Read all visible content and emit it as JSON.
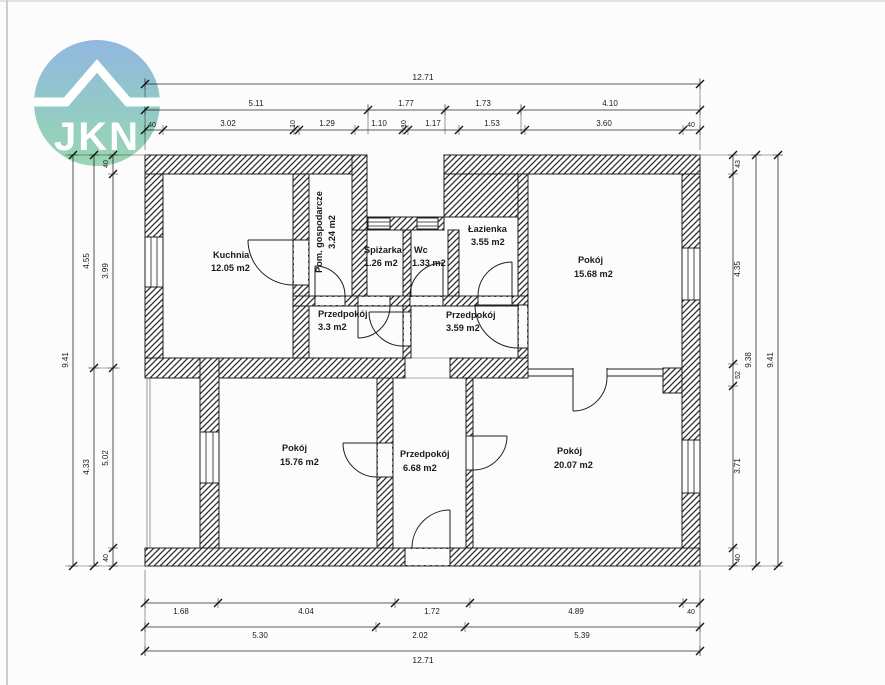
{
  "logo": {
    "text": "JKN"
  },
  "colors": {
    "logo_top": "#8bb3e2",
    "logo_bottom": "#93d6ac",
    "line": "#1f1f1f",
    "background": "#fcfcfc"
  },
  "rooms": {
    "kuchnia": {
      "name": "Kuchnia",
      "area": "12.05 m2"
    },
    "pom_gosp": {
      "name": "Pom. gospodarcze",
      "area": "3.24 m2"
    },
    "spizarka": {
      "name": "Spiżarka",
      "area": "1.26 m2"
    },
    "wc": {
      "name": "Wc",
      "area": "1.33 m2"
    },
    "lazienka": {
      "name": "Łazienka",
      "area": "3.55 m2"
    },
    "pokoj_gorny": {
      "name": "Pokój",
      "area": "15.68 m2"
    },
    "przedpokoj_1": {
      "name": "Przedpokój",
      "area": "3.3 m2"
    },
    "przedpokoj_2": {
      "name": "Przedpokój",
      "area": "3.59 m2"
    },
    "pokoj_dolny_lewy": {
      "name": "Pokój",
      "area": "15.76 m2"
    },
    "przedpokoj_3": {
      "name": "Przedpokój",
      "area": "6.68 m2"
    },
    "pokoj_dolny_prawy": {
      "name": "Pokój",
      "area": "20.07 m2"
    }
  },
  "dims": {
    "top_total": "12.71",
    "top_row2": [
      "5.11",
      "1.77",
      "1.73",
      "4.10"
    ],
    "top_row3": [
      "40",
      "3.02",
      "10",
      "1.29",
      "1.10",
      "10",
      "1.17",
      "1.53",
      "3.60",
      "40"
    ],
    "bottom_row1": [
      "1.68",
      "4.04",
      "1.72",
      "4.89",
      "40"
    ],
    "bottom_row2": [
      "5.30",
      "2.02",
      "5.39"
    ],
    "bottom_total": "12.71",
    "left_outer": "9.41",
    "left_mid": [
      "4.55",
      "4.33"
    ],
    "left_inner": [
      "40",
      "3.99",
      "5.02",
      "40"
    ],
    "right_inner": [
      "43",
      "4.35",
      "52",
      "3.71",
      "40"
    ],
    "right_mid": "9.38",
    "right_outer": "9.41"
  }
}
